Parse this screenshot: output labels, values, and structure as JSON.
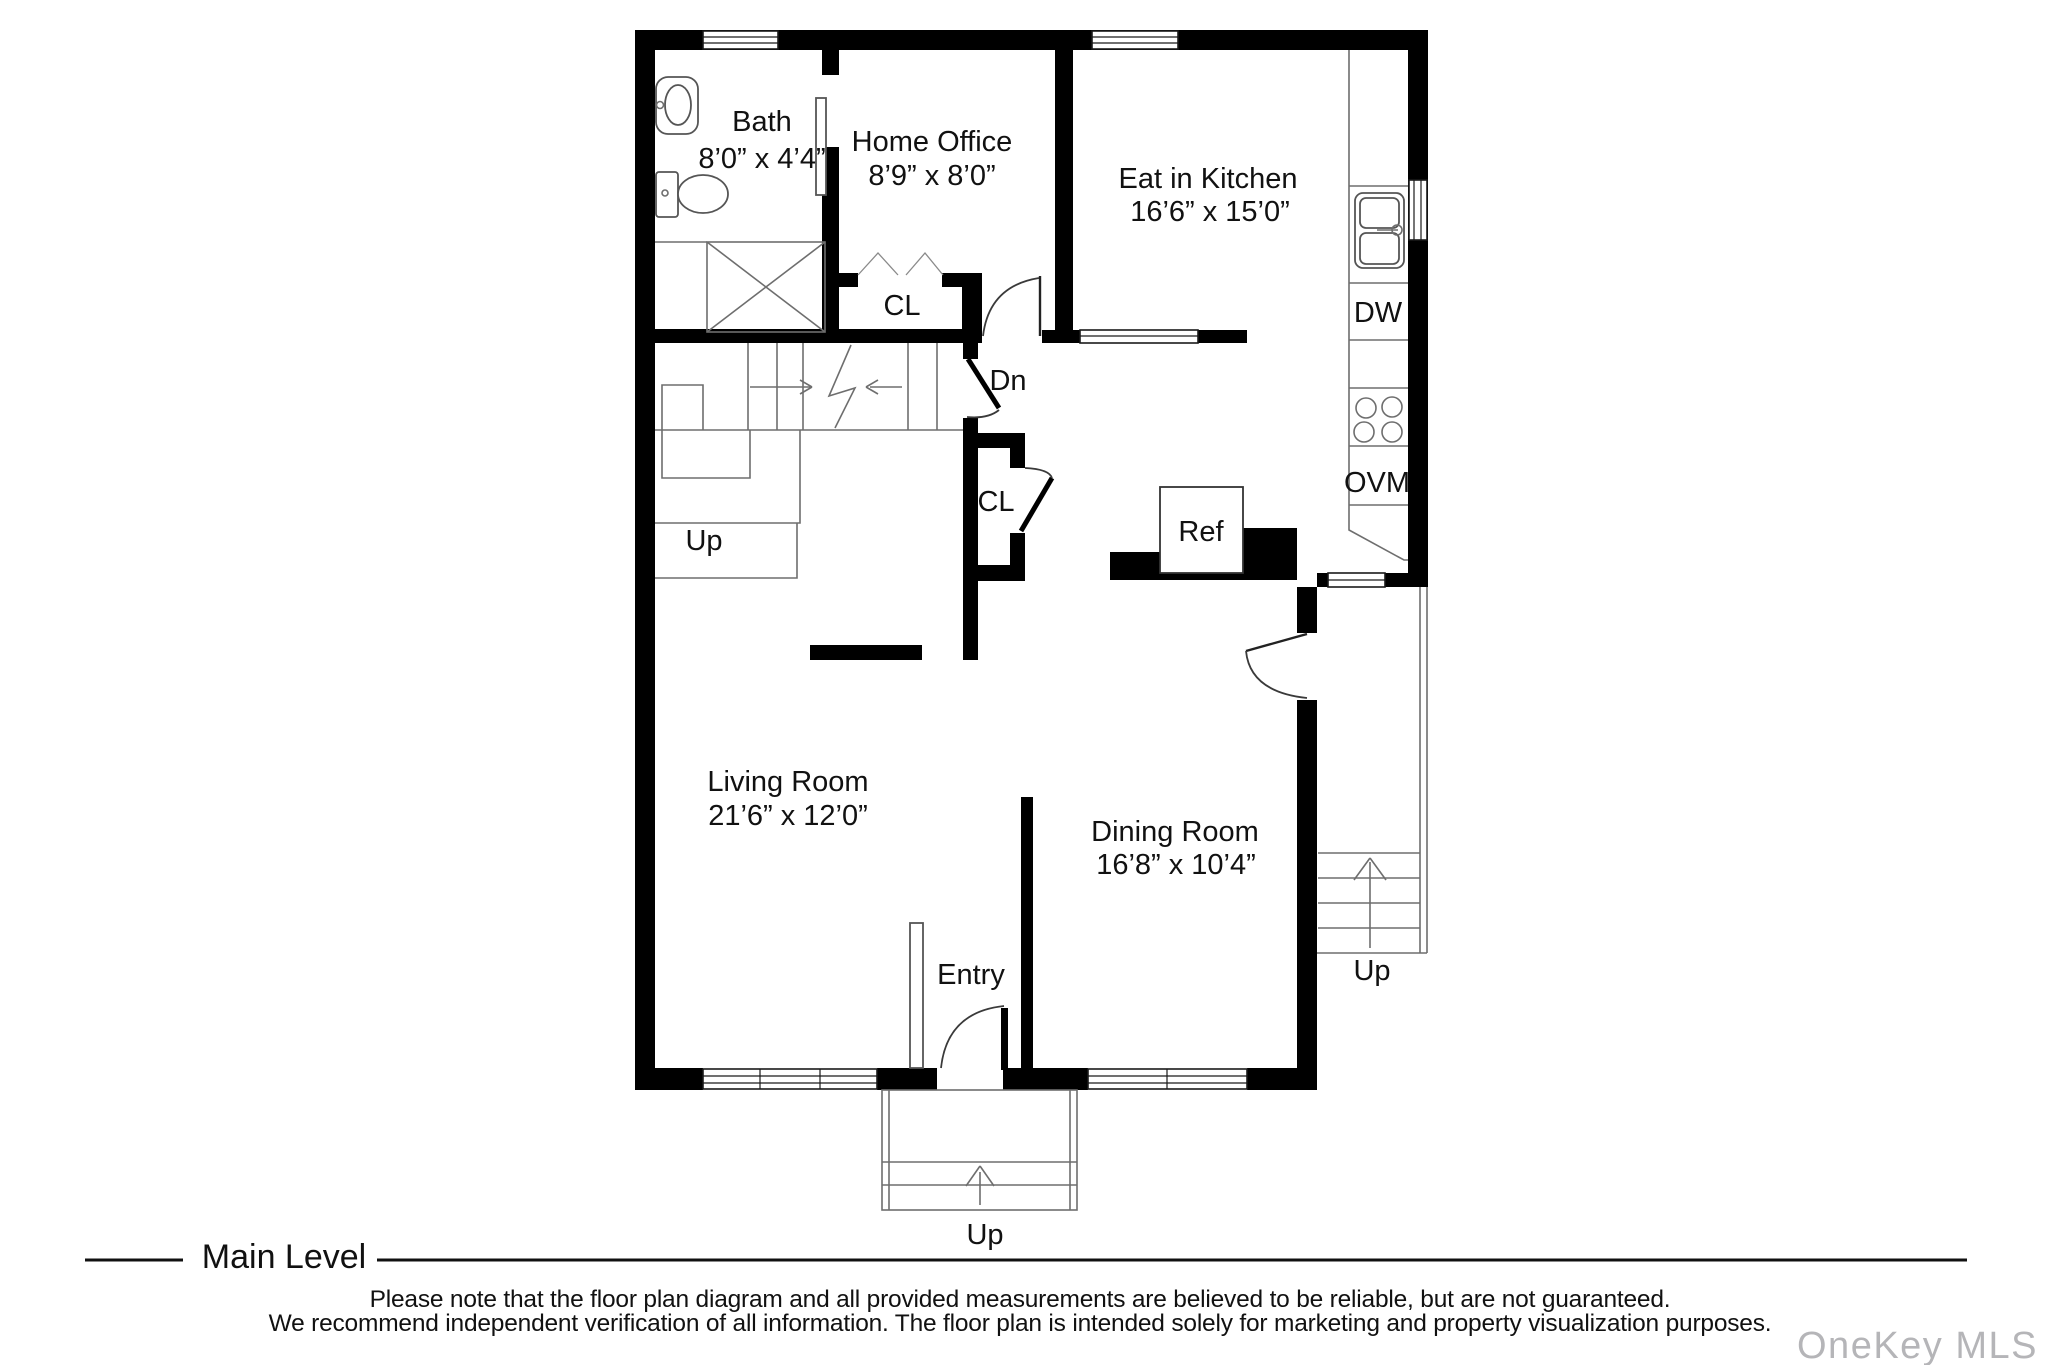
{
  "floor_plan": {
    "rooms": {
      "bath": {
        "name": "Bath",
        "dims": "8’0” x 4’4”"
      },
      "home_office": {
        "name": "Home Office",
        "dims": "8’9” x 8’0”"
      },
      "kitchen": {
        "name": "Eat in Kitchen",
        "dims": "16’6” x 15’0”"
      },
      "living": {
        "name": "Living Room",
        "dims": "21’6” x 12’0”"
      },
      "dining": {
        "name": "Dining Room",
        "dims": "16’8” x 10’4”"
      }
    },
    "labels": {
      "closet": "CL",
      "down": "Dn",
      "up": "Up",
      "entry": "Entry",
      "fridge": "Ref",
      "dishwasher": "DW",
      "oven_microwave": "OVM"
    }
  },
  "footer": {
    "level": "Main Level",
    "disclaimer_line1": "Please note that the floor plan diagram and all provided measurements are believed to be reliable, but are not guaranteed.",
    "disclaimer_line2": "We recommend independent verification of all information. The floor plan is intended solely for marketing and property visualization purposes.",
    "watermark": "OneKey MLS"
  },
  "colors": {
    "wall": "#000000",
    "detail_line": "#6e6e6e",
    "text": "#111111",
    "watermark": "#b5b5b8"
  }
}
